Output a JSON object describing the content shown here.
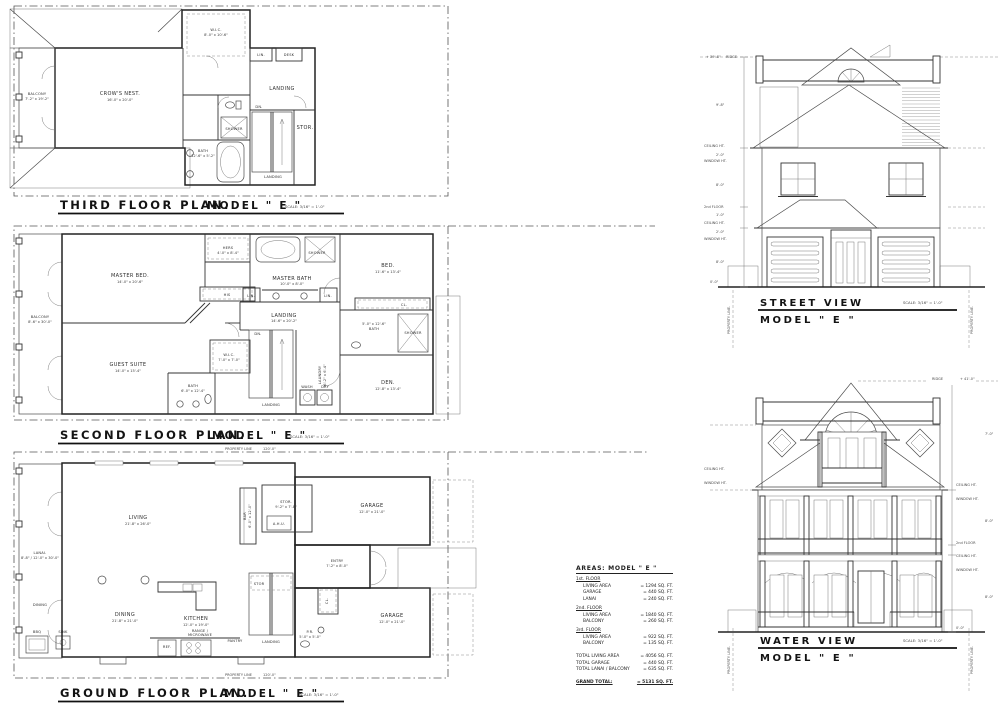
{
  "meta": {
    "model": "MODEL \" E \"",
    "scale": "SCALE: 3/16\" = 1'-0\"",
    "property_line": "PROPERTY LINE",
    "property_length": "120'-0\"",
    "property_line_v": "PROPERTY LINE."
  },
  "plans": {
    "third": {
      "title": "THIRD FLOOR PLAN.",
      "rooms": {
        "wic": {
          "label": "W.I.C.",
          "dim": "8'-0\" x 10'-6\""
        },
        "lin": {
          "label": "LIN."
        },
        "desk": {
          "label": "DESK"
        },
        "landing": {
          "label": "LANDING"
        },
        "crows": {
          "label": "CROW'S NEST.",
          "dim": "16'-0\" x 20'-0\""
        },
        "balcony": {
          "label": "BALCONY",
          "dim": "7'-2\" x 19'-2\""
        },
        "dn": {
          "label": "DN."
        },
        "stor": {
          "label": "STOR."
        },
        "shower": {
          "label": "SHOWER"
        },
        "bath": {
          "label": "BATH",
          "dim": "12'-6\" x 5'-2\""
        },
        "landing2": {
          "label": "LANDING"
        }
      }
    },
    "second": {
      "title": "SECOND FLOOR PLAN.",
      "rooms": {
        "balcony": {
          "label": "BALCONY",
          "dim": "8'-6\" x 30'-0\""
        },
        "master_bed": {
          "label": "MASTER BED.",
          "dim": "14'-0\" x 20'-6\""
        },
        "hers": {
          "label": "HERS",
          "dim": "4'-0\" x 8'-4\""
        },
        "his": {
          "label": "HIS"
        },
        "guest": {
          "label": "GUEST SUITE",
          "dim": "14'-0\" x 15'-4\""
        },
        "wic": {
          "label": "W.I.C.",
          "dim": "7'-0\" x 7'-0\""
        },
        "bath1": {
          "label": "BATH",
          "dim": "6'-0\" x 12'-4\""
        },
        "master_bath": {
          "label": "MASTER BATH",
          "dim": "10'-0\" x 8'-0\""
        },
        "lin1": {
          "label": "LIN."
        },
        "lin2": {
          "label": "LIN."
        },
        "landing": {
          "label": "LANDING",
          "dim": "14'-6\" x 20'-2\""
        },
        "dn": {
          "label": "DN."
        },
        "bed": {
          "label": "BED.",
          "dim": "11'-6\" x 13'-4\""
        },
        "cl": {
          "label": "CL."
        },
        "bath2": {
          "label": "BATH",
          "dim": "5'-0\" x 12'-6\""
        },
        "shower1": {
          "label": "SHOWER"
        },
        "shower2": {
          "label": "SHOWER"
        },
        "den": {
          "label": "DEN.",
          "dim": "12'-8\" x 13'-4\""
        },
        "laundry": {
          "label": "LAUNDRY",
          "dim": "6'-2\" x 6'-4\""
        },
        "wash": {
          "label": "WASH"
        },
        "dry": {
          "label": "DRY"
        },
        "landing2": {
          "label": "LANDING"
        }
      }
    },
    "ground": {
      "title": "GROUND FLOOR PLAN.",
      "rooms": {
        "lanai": {
          "label": "LANAI.",
          "dim": "8'-8\" / 12'-0\" x 30'-0\""
        },
        "dining_lanai": {
          "label": "DINING"
        },
        "living": {
          "label": "LIVING",
          "dim": "21'-8\" x 26'-0\""
        },
        "dining": {
          "label": "DINING",
          "dim": "21'-8\" x 21'-0\""
        },
        "kitchen": {
          "label": "KITCHEN",
          "dim": "12'-0\" x 19'-0\""
        },
        "range": {
          "label": "RANGE /",
          "dim": "MICROWAVE"
        },
        "ref": {
          "label": "REF."
        },
        "pantry": {
          "label": "PANTRY"
        },
        "bbq": {
          "label": "BBQ"
        },
        "sink": {
          "label": "SINK"
        },
        "bar": {
          "label": "BAR",
          "dim": "6'-0\" x 12'-0\""
        },
        "stor": {
          "label": "STOR.",
          "dim": "9'-2\" x 7'-8\""
        },
        "ahu": {
          "label": "A.H.U."
        },
        "garage1": {
          "label": "GARAGE",
          "dim": "12'-0\" x 21'-0\""
        },
        "entry": {
          "label": "ENTRY",
          "dim": "7'-2\" x 8'-0\""
        },
        "stor2": {
          "label": "STOR"
        },
        "landing": {
          "label": "LANDING"
        },
        "pr": {
          "label": "P.R.",
          "dim": "5'-0\" x 5'-0\""
        },
        "cl": {
          "label": "CL."
        },
        "garage2": {
          "label": "GARAGE",
          "dim": "12'-0\" x 21'-0\""
        }
      }
    }
  },
  "elevations": {
    "street": {
      "title": "STREET VIEW",
      "ridge_note": "RIDGE",
      "ridge_elev": "+ 39'-8\"",
      "ann": {
        "ceiling": "CEILING HT.",
        "window": "WINDOW HT.",
        "second_floor": "2nd FLOOR",
        "zero": "0'-0\"",
        "d1": "9'-8\"",
        "d2": "2'-0\"",
        "d3": "8'-0\"",
        "d4": "1'-0\"",
        "d5": "2'-0\"",
        "d6": "8'-0\""
      }
    },
    "water": {
      "title": "WATER VIEW",
      "ridge_note": "RIDGE",
      "ridge_elev": "+ 41'-0\"",
      "ann": {
        "ceiling": "CEILING HT.",
        "window": "WINDOW HT.",
        "second_floor": "2nd FLOOR",
        "zero": "0'-0\"",
        "d1": "7'-0\"",
        "d2": "8'-0\"",
        "d3": "8'-0\""
      }
    }
  },
  "areas": {
    "title": "AREAS: MODEL \" E \"",
    "rows": [
      {
        "label": "1st. FLOOR",
        "value": ""
      },
      {
        "label": "LIVING AREA",
        "value": "= 1294 SQ. FT."
      },
      {
        "label": "GARAGE",
        "value": "= 440 SQ. FT."
      },
      {
        "label": "LANAI",
        "value": "= 240 SQ. FT."
      },
      {
        "label": "2nd. FLOOR",
        "value": ""
      },
      {
        "label": "LIVING AREA",
        "value": "= 1840 SQ. FT."
      },
      {
        "label": "BALCONY",
        "value": "= 260 SQ. FT."
      },
      {
        "label": "3rd. FLOOR",
        "value": ""
      },
      {
        "label": "LIVING AREA",
        "value": "= 922 SQ. FT."
      },
      {
        "label": "BALCONY",
        "value": "= 135 SQ. FT."
      },
      {
        "label": "TOTAL LIVING AREA",
        "value": "= 4056 SQ. FT."
      },
      {
        "label": "TOTAL GARAGE",
        "value": "= 440 SQ. FT."
      },
      {
        "label": "TOTAL LANAI / BALCONY",
        "value": "= 635 SQ. FT."
      },
      {
        "label": "GRAND TOTAL:",
        "value": "= 5131 SQ. FT."
      }
    ]
  }
}
